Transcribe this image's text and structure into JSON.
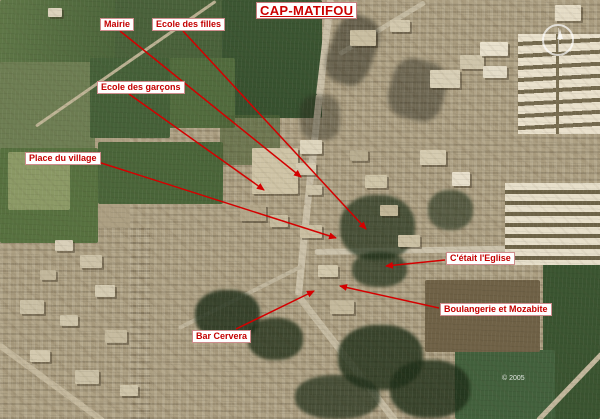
{
  "title": {
    "text": "CAP-MATIFOU"
  },
  "watermark": {
    "text": "© 2005"
  },
  "compass": {
    "name": "compass-rose"
  },
  "colors": {
    "annotation_red": "#d40000",
    "label_text_red": "#c40000",
    "label_background": "#ffffff"
  },
  "annotations": [
    {
      "id": "mairie",
      "label": "Mairie",
      "box": {
        "x": 100,
        "y": 18
      },
      "arrow": {
        "x1": 120,
        "y1": 31,
        "x2": 301,
        "y2": 177
      }
    },
    {
      "id": "ecole-des-filles",
      "label": "Ecole des filles",
      "box": {
        "x": 152,
        "y": 18
      },
      "arrow": {
        "x1": 183,
        "y1": 31,
        "x2": 366,
        "y2": 229
      }
    },
    {
      "id": "ecole-des-garcons",
      "label": "Ecole des garçons",
      "box": {
        "x": 97,
        "y": 81
      },
      "arrow": {
        "x1": 129,
        "y1": 94,
        "x2": 264,
        "y2": 190
      }
    },
    {
      "id": "place-du-village",
      "label": "Place du village",
      "box": {
        "x": 25,
        "y": 152
      },
      "arrow": {
        "x1": 98,
        "y1": 162,
        "x2": 336,
        "y2": 238
      }
    },
    {
      "id": "eglise",
      "label": "C'était l'Eglise",
      "box": {
        "x": 446,
        "y": 252
      },
      "arrow": {
        "x1": 445,
        "y1": 260,
        "x2": 386,
        "y2": 266
      }
    },
    {
      "id": "boulangerie",
      "label": "Boulangerie et Mozabite",
      "box": {
        "x": 440,
        "y": 303
      },
      "arrow": {
        "x1": 439,
        "y1": 308,
        "x2": 340,
        "y2": 286
      }
    },
    {
      "id": "bar-cervera",
      "label": "Bar Cervera",
      "box": {
        "x": 192,
        "y": 330
      },
      "arrow": {
        "x1": 236,
        "y1": 329,
        "x2": 314,
        "y2": 291
      }
    }
  ]
}
